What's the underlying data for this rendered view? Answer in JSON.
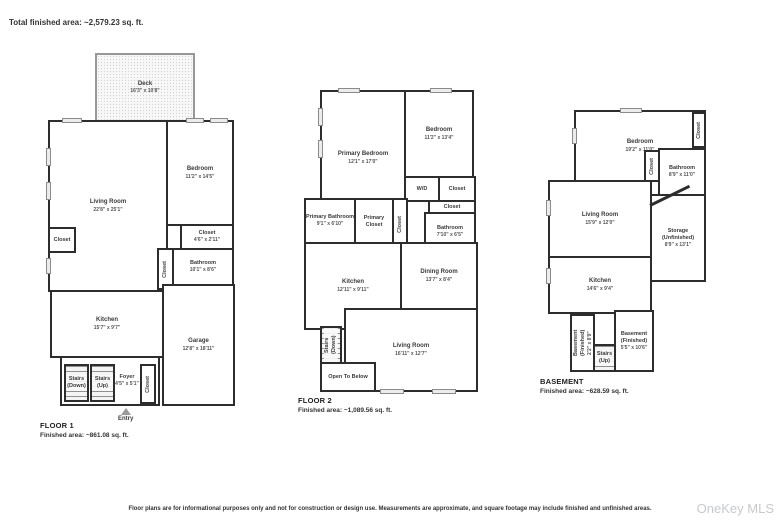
{
  "header": {
    "total_area": "Total finished area: ~2,579.23 sq. ft."
  },
  "footer": {
    "disclaimer": "Floor plans are for informational purposes only and not for construction or design use. Measurements are approximate, and square footage may include finished and unfinished areas.",
    "watermark": "OneKey MLS"
  },
  "floor1": {
    "title": "FLOOR 1",
    "area": "Finished area: ~861.08 sq. ft.",
    "rooms": {
      "deck": {
        "name": "Deck",
        "dims": "16'3\" x 10'8\""
      },
      "living_room": {
        "name": "Living Room",
        "dims": "22'8\" x 25'1\""
      },
      "bedroom": {
        "name": "Bedroom",
        "dims": "11'2\" x 14'5\""
      },
      "closet_bedroom": {
        "name": "Closet",
        "dims": "4'6\" x 2'11\""
      },
      "bathroom": {
        "name": "Bathroom",
        "dims": "10'1\" x 8'6\""
      },
      "closet_hall": {
        "name": "Closet"
      },
      "closet_left": {
        "name": "Closet"
      },
      "kitchen": {
        "name": "Kitchen",
        "dims": "15'7\" x 9'7\""
      },
      "garage": {
        "name": "Garage",
        "dims": "12'8\" x 18'11\""
      },
      "stairs_down": {
        "name": "Stairs (Down)"
      },
      "stairs_up": {
        "name": "Stairs (Up)"
      },
      "foyer": {
        "name": "Foyer",
        "dims": "4'5\" x 5'1\""
      },
      "closet_entry": {
        "name": "Closet"
      },
      "entry": {
        "name": "Entry"
      }
    }
  },
  "floor2": {
    "title": "FLOOR 2",
    "area": "Finished area: ~1,089.56 sq. ft.",
    "rooms": {
      "primary_bedroom": {
        "name": "Primary Bedroom",
        "dims": "12'1\" x 17'0\""
      },
      "bedroom": {
        "name": "Bedroom",
        "dims": "11'2\" x 13'4\""
      },
      "wd": {
        "name": "W/D"
      },
      "closet_wd": {
        "name": "Closet"
      },
      "closet_bath": {
        "name": "Closet"
      },
      "bathroom": {
        "name": "Bathroom",
        "dims": "7'10\" x 6'5\""
      },
      "primary_bathroom": {
        "name": "Primary Bathroom",
        "dims": "9'1\" x 6'10\""
      },
      "primary_closet": {
        "name": "Primary Closet"
      },
      "closet_hall": {
        "name": "Closet"
      },
      "kitchen": {
        "name": "Kitchen",
        "dims": "12'11\" x 9'11\""
      },
      "dining_room": {
        "name": "Dining Room",
        "dims": "13'7\" x 8'4\""
      },
      "stairs_down": {
        "name": "Stairs (Down)"
      },
      "open_to_below": {
        "name": "Open To Below"
      },
      "living_room": {
        "name": "Living Room",
        "dims": "16'11\" x 12'7\""
      }
    }
  },
  "basement": {
    "title": "BASEMENT",
    "area": "Finished area: ~628.59 sq. ft.",
    "rooms": {
      "bedroom": {
        "name": "Bedroom",
        "dims": "19'2\" x 11'0\""
      },
      "closet_top": {
        "name": "Closet"
      },
      "closet_mid": {
        "name": "Closet"
      },
      "bathroom": {
        "name": "Bathroom",
        "dims": "8'9\" x 11'0\""
      },
      "living_room": {
        "name": "Living Room",
        "dims": "15'9\" x 12'0\""
      },
      "storage": {
        "name": "Storage (Unfinished)",
        "dims": "8'9\" x 13'1\""
      },
      "kitchen": {
        "name": "Kitchen",
        "dims": "14'6\" x 9'4\""
      },
      "basement_fin_small": {
        "name": "Basement (Finished)",
        "dims": "2'2\" x 8'9\""
      },
      "stairs_up": {
        "name": "Stairs (Up)"
      },
      "basement_fin": {
        "name": "Basement (Finished)",
        "dims": "5'5\" x 10'6\""
      }
    }
  }
}
